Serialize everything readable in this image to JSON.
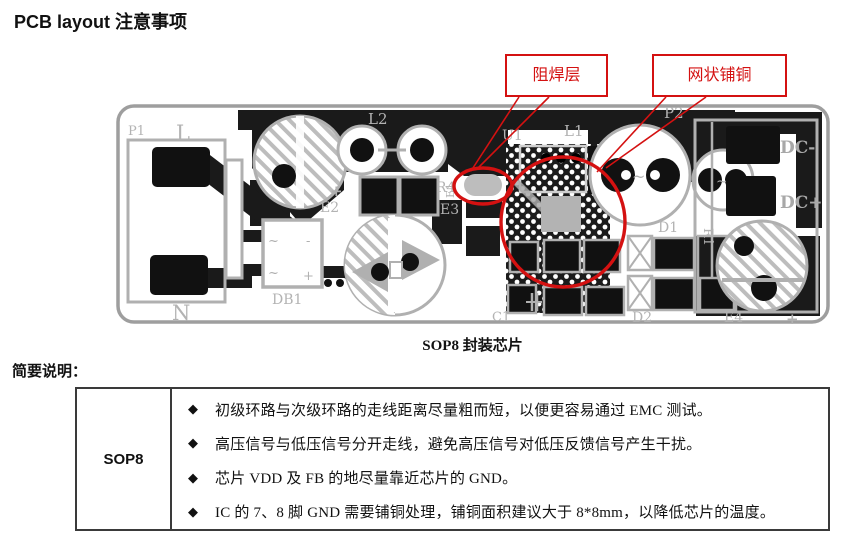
{
  "page": {
    "title": "PCB layout 注意事项",
    "section_label": "简要说明：",
    "figure_caption": "SOP8 封装芯片"
  },
  "callouts": {
    "solder_mask_label": "阻焊层",
    "mesh_copper_label": "网状铺铜",
    "accent_color": "#d41111"
  },
  "pcb": {
    "labels": {
      "p1": "P1",
      "l": "L",
      "n": "N",
      "db1": "DB1",
      "e2": "E2",
      "l2": "L2",
      "r4": "R4",
      "e3": "E3",
      "e1": "E1",
      "u1": "U1",
      "c1": "C1",
      "l1": "L1",
      "p2": "P2",
      "dc_minus": "DC-",
      "dc_plus": "DC+",
      "d1": "D1",
      "r1": "R1",
      "d2": "D2",
      "e4": "E4",
      "plus": "+",
      "minus": "-",
      "tilde": "~"
    }
  },
  "table": {
    "row_header": "SOP8",
    "items": [
      {
        "bullet": "◆",
        "text": "初级环路与次级环路的走线距离尽量粗而短，以便更容易通过 EMC 测试。"
      },
      {
        "bullet": "◆",
        "text": "高压信号与低压信号分开走线，避免高压信号对低压反馈信号产生干扰。"
      },
      {
        "bullet": "◆",
        "text": "芯片 VDD 及 FB 的地尽量靠近芯片的 GND。"
      },
      {
        "bullet": "◆",
        "text": "IC 的 7、8 脚 GND 需要铺铜处理，铺铜面积建议大于 8*8mm，以降低芯片的温度。"
      }
    ]
  }
}
